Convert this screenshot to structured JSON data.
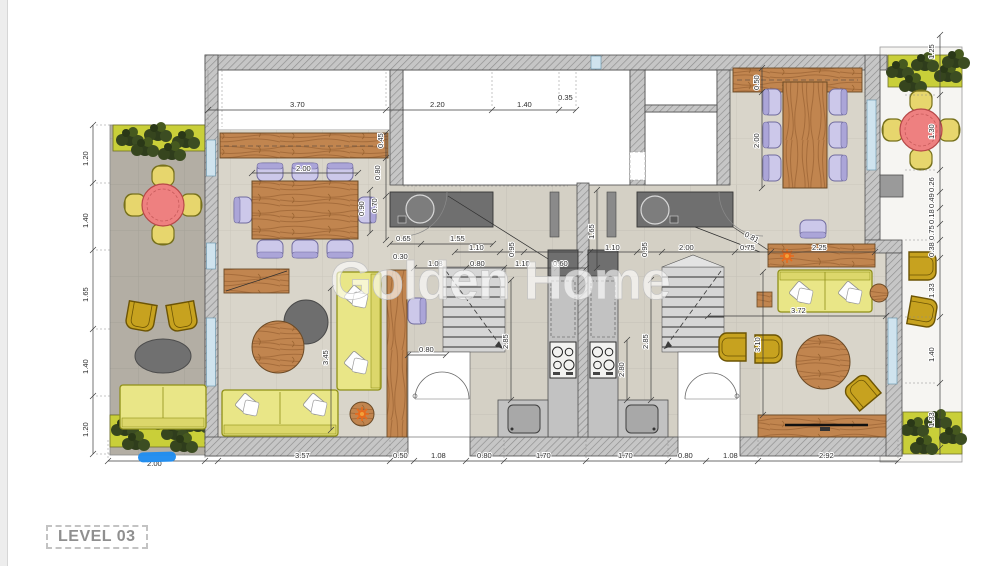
{
  "watermark": "Golden Home",
  "level_label": "LEVEL 03",
  "colors": {
    "wall_hatch": "#c6c6c6",
    "floor_beige": "#d9d5ca",
    "balcony_gray": "#b3aea4",
    "wood": "#c1854f",
    "sofa_yellow": "#e9e687",
    "chair_lavender": "#ccc8ea",
    "chair_mustard": "#c7a21f",
    "table_red": "#ee8080",
    "planter_green": "#c9cf39",
    "counter_dark": "#6f6f6f",
    "counter_light": "#c2c2c2",
    "annotation_blue": "#1f8cf0",
    "accent_orange": "#e86a1c"
  },
  "icons": {
    "plant": "bush-cluster",
    "dining_table": "wood-rect",
    "round_table": "wood-circle",
    "outdoor_table": "red-circle",
    "stove": "four-burner",
    "sink": "rounded-basin",
    "stairs": "treads-with-break-line",
    "door": "swing-arc",
    "tv": "thin-black-bar",
    "flower": "orange-blossom"
  },
  "dims": {
    "top": [
      "3.70",
      "2.20",
      "1.40",
      "0.35"
    ],
    "bottom": [
      "2.00",
      "3.57",
      "0.50",
      "1.08",
      "0.80",
      "1.70",
      "1.70",
      "0.80",
      "1.08",
      "2.92"
    ],
    "left": [
      "1.20",
      "1.40",
      "1.65",
      "1.40",
      "1.20"
    ],
    "right": [
      "1.25",
      "1.30",
      "0.26",
      "0.49",
      "0.18",
      "0.75",
      "0.38",
      "1.33",
      "1.40",
      "1.33"
    ],
    "interior": [
      "2.00",
      "0.45",
      "0.80",
      "0.70",
      "0.90",
      "0.65",
      "1.55",
      "0.30",
      "1.08",
      "0.80",
      "1.10",
      "0.60",
      "1.10",
      "0.95",
      "1.65",
      "1.10",
      "0.95",
      "2.00",
      "0.75",
      "2.25",
      "0.81",
      "0.50",
      "2.00",
      "2.85",
      "2.85",
      "2.80",
      "3.45",
      "0.80",
      "3.10",
      "3.72"
    ]
  }
}
